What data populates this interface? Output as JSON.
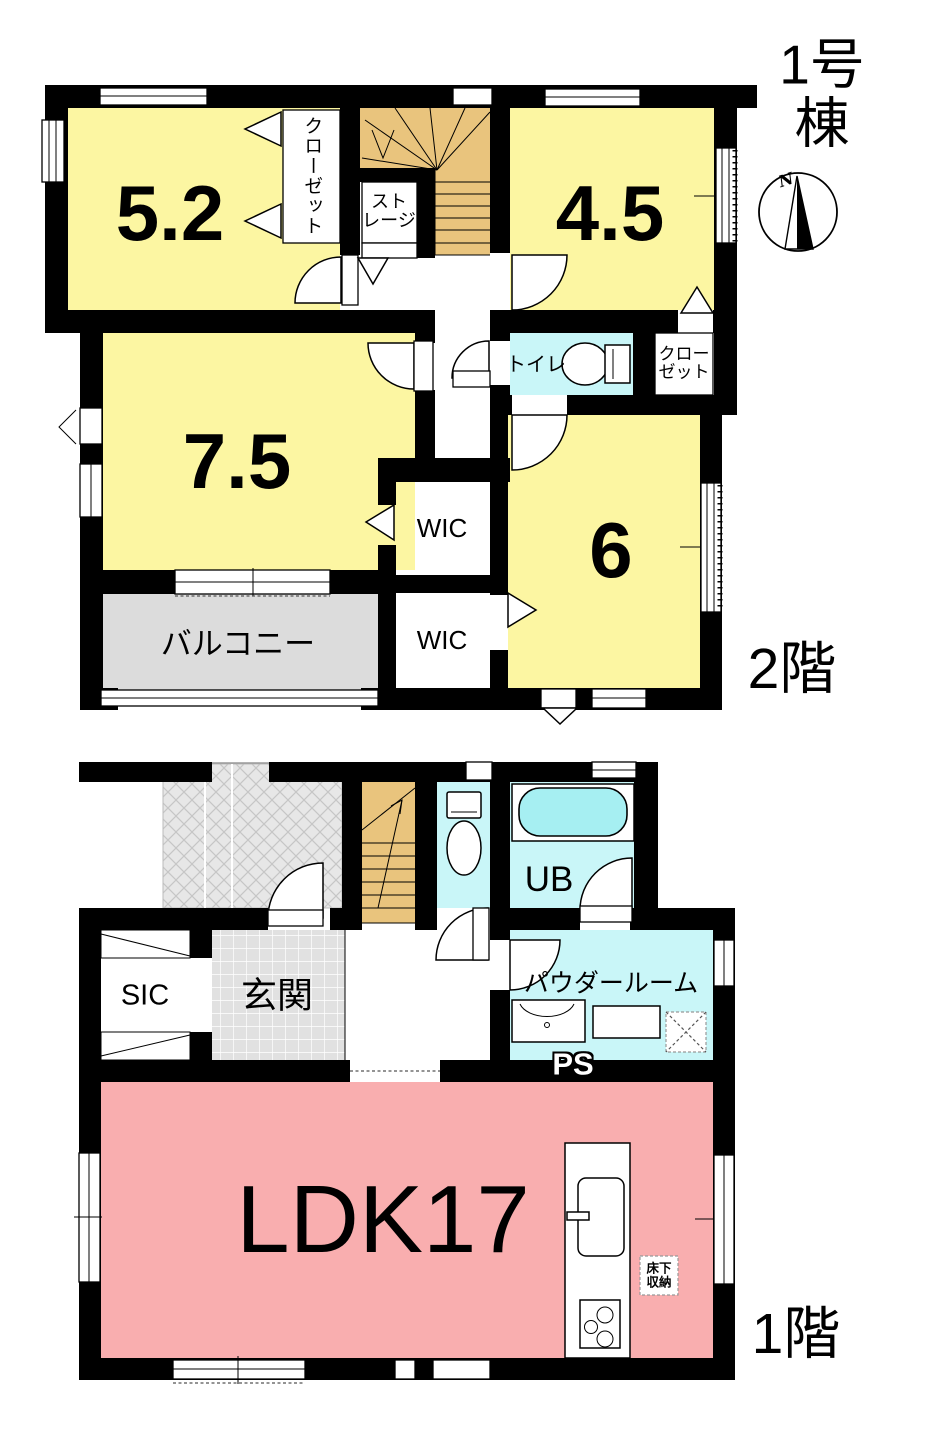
{
  "building_title": "1号棟",
  "compass": {
    "north": "N"
  },
  "floor_2": {
    "label": "2階",
    "room_5_2": "5.2",
    "room_4_5": "4.5",
    "room_7_5": "7.5",
    "room_6": "6",
    "closet_left": "クローゼット",
    "storage": "スト\nレージ",
    "toilet": "トイレ",
    "closet_right": "クロー\nゼット",
    "wic_upper": "WIC",
    "wic_lower": "WIC",
    "balcony": "バルコニー"
  },
  "floor_1": {
    "label": "1階",
    "ldk": "LDK17",
    "entrance": "玄関",
    "shoe_closet": "SIC",
    "unit_bath": "UB",
    "powder_room": "パウダールーム",
    "pipe_space": "PS",
    "underfloor_storage": "床下\n収納"
  },
  "colors": {
    "room_yellow": "#FCF6A2",
    "stairs_tan": "#E9C47D",
    "wet_cyan": "#C9F6F8",
    "bathtub_cyan": "#A6EFF2",
    "ldk_pink": "#F9AEAF",
    "balcony_gray": "#DCDCDC",
    "tile_gray": "#E1E1E1",
    "wall_black": "#000000"
  }
}
